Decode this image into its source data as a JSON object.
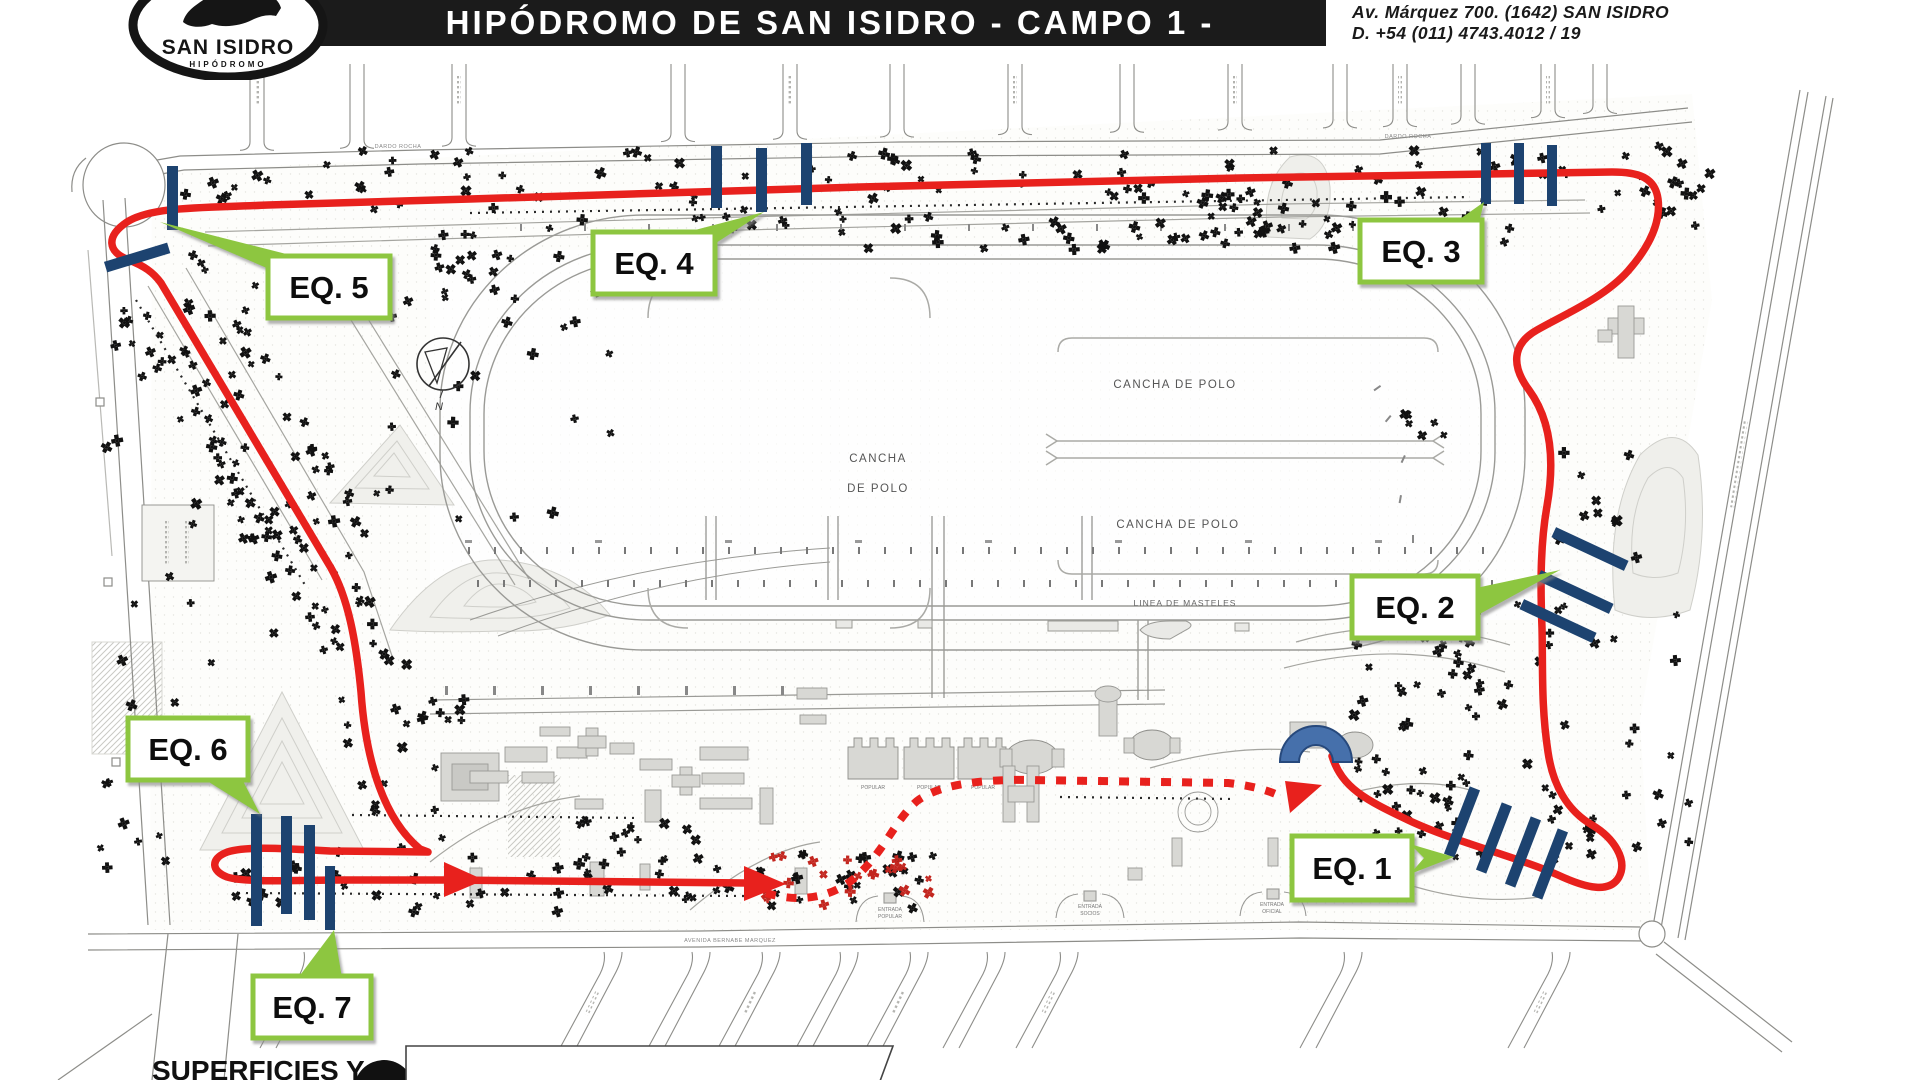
{
  "header": {
    "logo_line1": "SAN ISIDRO",
    "logo_line2": "HIPÓDROMO",
    "title": "HIPÓDROMO DE SAN ISIDRO - CAMPO 1 -",
    "address_line1": "Av. Márquez 700. (1642) SAN ISIDRO",
    "address_line2": "D. +54 (011) 4743.4012 / 19"
  },
  "map": {
    "checkpoints": [
      {
        "label": "EQ. 1"
      },
      {
        "label": "EQ. 2"
      },
      {
        "label": "EQ. 3"
      },
      {
        "label": "EQ. 4"
      },
      {
        "label": "EQ. 5"
      },
      {
        "label": "EQ. 6"
      },
      {
        "label": "EQ. 7"
      }
    ],
    "fields": {
      "polo_left_line1": "CANCHA",
      "polo_left_line2": "DE POLO",
      "polo_top": "CANCHA DE POLO",
      "polo_bottom": "CANCHA DE POLO",
      "masts_line": "LINEA DE MASTELES"
    },
    "streets": {
      "top": "DARDO ROCHA",
      "south": "AVENIDA BERNABE MARQUEZ"
    },
    "entrances": [
      {
        "line1": "ENTRADA",
        "line2": "POPULAR"
      },
      {
        "line1": "ENTRADA",
        "line2": "SOCIOS"
      },
      {
        "line1": "ENTRADA",
        "line2": "OFICIAL"
      }
    ],
    "stands": {
      "label": "POPULAR"
    },
    "compass": "N",
    "legend": {
      "prefix": "SUPERFICIES Y"
    },
    "colors": {
      "route": "#e8211d",
      "tick_marker": "#1d4370",
      "checkpoint_border": "#8dc63f",
      "arch": "#4670ab",
      "header_bg": "#1b1b1b"
    }
  }
}
